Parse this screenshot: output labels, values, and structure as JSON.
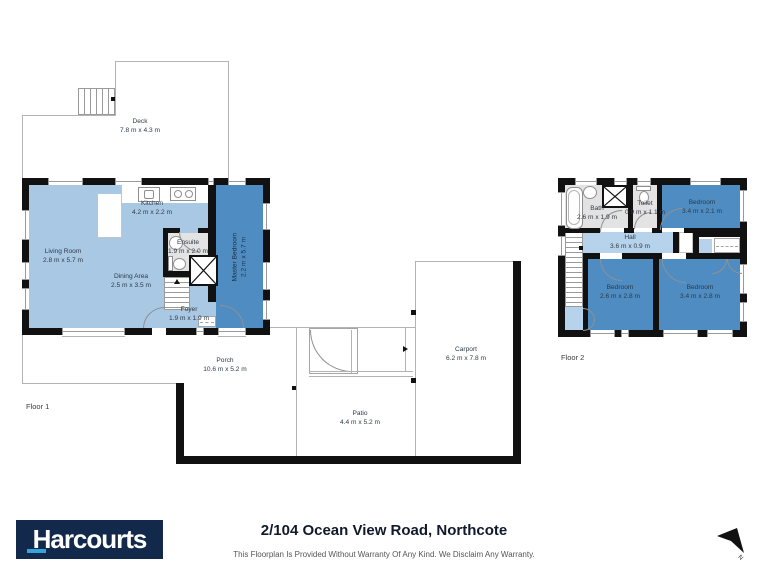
{
  "colors": {
    "wall": "#111111",
    "room_light_blue": "#a9c8e4",
    "room_dark_blue": "#4e8cc2",
    "room_hall_blue": "#b7d3ec",
    "room_gray": "#e3e3e3",
    "brand_navy": "#12294b",
    "brand_cyan": "#35a3dc"
  },
  "floor1": {
    "tag": "Floor 1",
    "deck": {
      "name": "Deck",
      "dims": "7.8 m x 4.3 m"
    },
    "living_room": {
      "name": "Living Room",
      "dims": "2.8 m x 5.7 m"
    },
    "kitchen": {
      "name": "Kitchen",
      "dims": "4.2 m x 2.2 m"
    },
    "dining_area": {
      "name": "Dining Area",
      "dims": "2.5 m x 3.5 m"
    },
    "ensuite": {
      "name": "Ensuite",
      "dims": "1.9 m x 2.0 m"
    },
    "master_bedroom": {
      "name": "Master Bedroom",
      "dims": "2.2 m x 5.7 m"
    },
    "foyer": {
      "name": "Foyer",
      "dims": "1.9 m x 1.9 m"
    },
    "porch": {
      "name": "Porch",
      "dims": "10.6 m x 5.2 m"
    },
    "patio": {
      "name": "Patio",
      "dims": "4.4 m x 5.2 m"
    },
    "carport": {
      "name": "Carport",
      "dims": "6.2 m x 7.8 m"
    }
  },
  "floor2": {
    "tag": "Floor 2",
    "bath": {
      "name": "Bath",
      "dims": "2.6 m x 1.9 m"
    },
    "toilet": {
      "name": "Toilet",
      "dims": "0.9 m x 1.1 m"
    },
    "bedroom_top": {
      "name": "Bedroom",
      "dims": "3.4 m x 2.1 m"
    },
    "hall": {
      "name": "Hall",
      "dims": "3.6 m x 0.9 m"
    },
    "bedroom_left": {
      "name": "Bedroom",
      "dims": "2.6 m x 2.8 m"
    },
    "bedroom_right": {
      "name": "Bedroom",
      "dims": "3.4 m x 2.8 m"
    }
  },
  "footer": {
    "brand": "Harcourts",
    "title": "2/104 Ocean View Road, Northcote",
    "disclaimer": "This Floorplan Is Provided Without Warranty Of Any Kind. We Disclaim Any Warranty.",
    "north_label": "N"
  }
}
